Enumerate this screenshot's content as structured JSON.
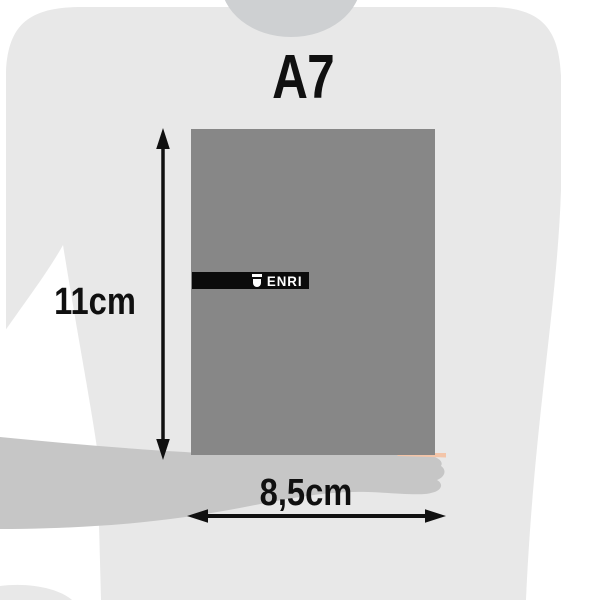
{
  "title": "A7",
  "product": {
    "brand": "ENRI",
    "brand_icon": "shield-icon",
    "cover_color": "#878787",
    "band_color": "#0b0b0b",
    "brand_text_color": "#ffffff",
    "pages_edge_color": "#f3c5a9"
  },
  "dimensions": {
    "height_label": "11cm",
    "width_label": "8,5cm",
    "annotation_color": "#101010"
  },
  "silhouette": {
    "shirt_color": "#e8e8e8",
    "neck_color": "#ced0d2",
    "arm_color": "#c6c6c6",
    "background_color": "#ffffff"
  }
}
